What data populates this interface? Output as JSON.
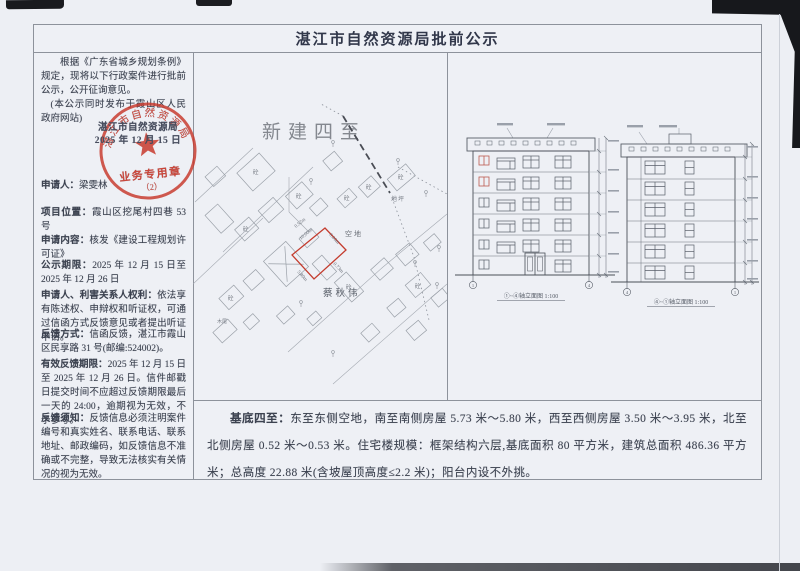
{
  "doc": {
    "title": "湛江市自然资源局批前公示"
  },
  "left_panel": {
    "intro1": "根据《广东省城乡规划条例》规定，现将以下行政案件进行批前公示，公开征询意见。",
    "intro2": "(本公示同时发布于霞山区人民政府网站)",
    "stamp": {
      "org_line": "湛江市自然资源局",
      "date_line": "2025 年 12 月 15 日",
      "seal_ring_text": "湛江市自然资源局",
      "seal_label": "业务专用章",
      "seal_number": "（2）"
    },
    "fields": [
      {
        "label": "申请人：",
        "value": "梁雯林"
      },
      {
        "label": "项目位置：",
        "value": "霞山区挖尾村四巷 53 号"
      },
      {
        "label": "申请内容：",
        "value": "核发《建设工程规划许可证》"
      },
      {
        "label": "公示期限：",
        "value": "2025 年 12 月 15 日至 2025 年 12 月 26 日"
      },
      {
        "label": "申请人、利害关系人权利：",
        "value": "依法享有陈述权、申辩权和听证权，可通过信函方式反馈意见或者提出听证申请。"
      },
      {
        "label": "反馈方式：",
        "value": "信函反馈，湛江市霞山区民享路 31 号(邮编:524002)。"
      },
      {
        "label": "有效反馈期限：",
        "value": "2025 年 12 月 15 日至 2025 年 12 月 26 日。信件邮戳日提交时间不应超过反馈期限最后一天的 24:00，逾期视为无效，不予参考。"
      },
      {
        "label": "反馈须知：",
        "value": "反馈信息必须注明案件编号和真实姓名、联系电话、联系地址、邮政编码，如反馈信息不准确或不完整，导致无法核实有关情况的视为无效。"
      }
    ]
  },
  "site_plan": {
    "heading": "新建四至",
    "area_label": "空地",
    "ground_label": "地坪",
    "name_label": "蔡秋伟",
    "timber_label": "木尾",
    "building_mark": "砼",
    "dims": {
      "d1": "10.00m",
      "d2": "8.00m",
      "d3": "0.73m",
      "d4": "5.80m",
      "d5": "0.52m"
    }
  },
  "elevations": {
    "left_caption": "①~④轴立面图 1:100",
    "right_caption": "④~①轴立面图 1:100",
    "axis_1": "1",
    "axis_4": "4"
  },
  "footer": {
    "label": "基底四至：",
    "body": "东至东侧空地，南至南侧房屋 5.73 米～5.80 米，西至西侧房屋 3.50 米～3.95 米，北至北侧房屋 0.52 米～0.53 米。住宅楼规模：框架结构六层,基底面积 80 平方米，建筑总面积 486.36 平方米；总高度 22.88 米(含坡屋顶高度≤2.2 米)；阳台内设不外挑。"
  },
  "colors": {
    "seal_red": "#c8392c",
    "parcel_red": "#c43c2e",
    "paper": "#edeff4",
    "border_gray": "#8d929b",
    "ink": "#3c4250"
  }
}
